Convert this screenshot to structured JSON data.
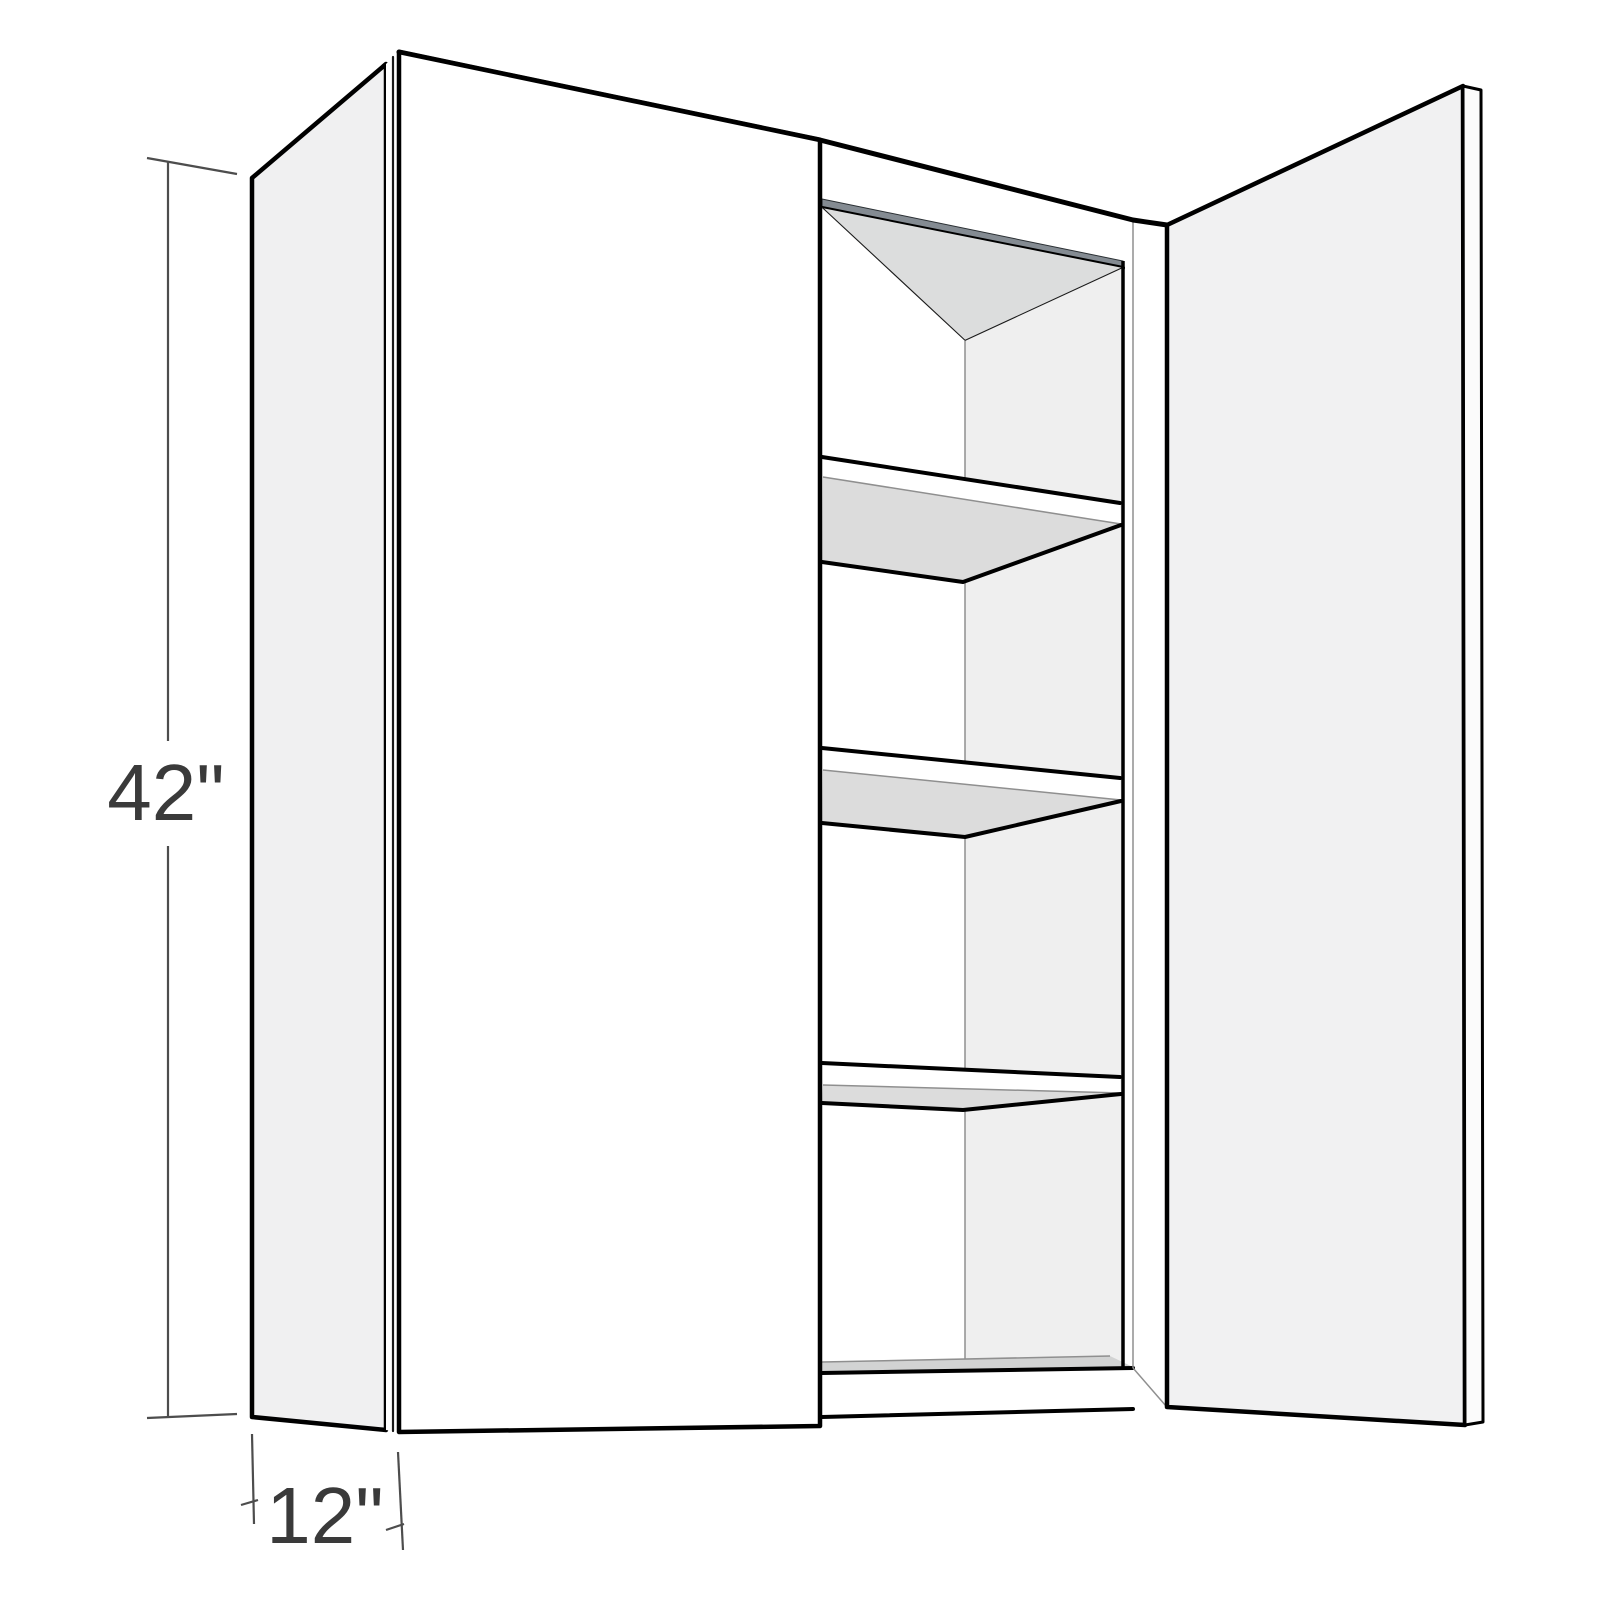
{
  "title": "Wall cabinet product dimension diagram",
  "dimensions": {
    "height": {
      "label": "42\""
    },
    "depth": {
      "label": "12\""
    }
  },
  "cabinet": {
    "shelf_count": 3,
    "doors": [
      "closed-left-door",
      "open-right-door"
    ]
  },
  "colors": {
    "background": "#ffffff",
    "outline": "#000000",
    "dimension_line": "#4d4d4d",
    "dimension_text": "#3a3a3a",
    "side_panel": "#f0f0f1",
    "door_front": "#ffffff",
    "door_open_face": "#f1f1f2",
    "door_open_edge": "#fbfbfb",
    "carcass_face": "#ffffff",
    "top_rail_strip": "#848b92",
    "ceiling": "#dcdddd",
    "back_panel": "#efefef",
    "left_wall": "#ffffff",
    "shelf_face": "#ffffff",
    "shelf_underside": "#dcdcdc",
    "floor": "#d2d3d3"
  }
}
